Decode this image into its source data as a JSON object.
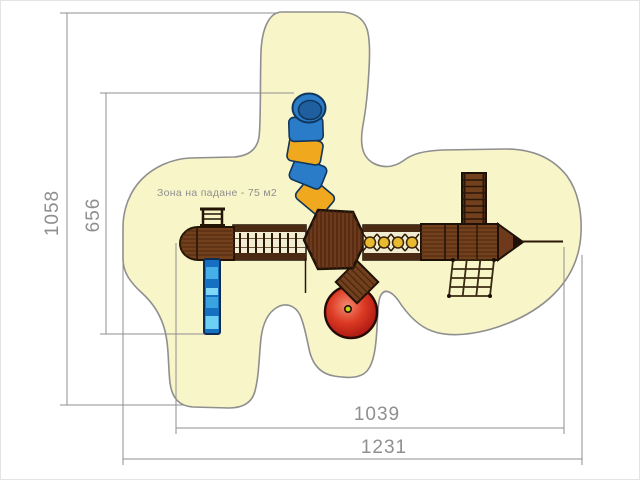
{
  "drawing": {
    "zone_label": "Зона на падане - 75 м2",
    "zone_area_m2": 75,
    "dimensions": {
      "site_height": "1058",
      "structure_height": "656",
      "structure_width": "1039",
      "site_width": "1231"
    },
    "colors": {
      "fall_zone_fill": "#f8f5c9",
      "fall_zone_outline": "#8f8f8f",
      "dimension_gray": "#8f8f8f",
      "wood_brown": "#73401e",
      "wood_dark_outline": "#1e1208",
      "slide_blue": "#1570c2",
      "slide_blue_light": "#6cd0f4",
      "tube_blue": "#2a7cc9",
      "tube_yellow": "#f0a81e",
      "net_ring_yellow": "#e9b92f",
      "carousel_red": "#c81d14",
      "deck_cream": "#f2ecd2"
    }
  }
}
